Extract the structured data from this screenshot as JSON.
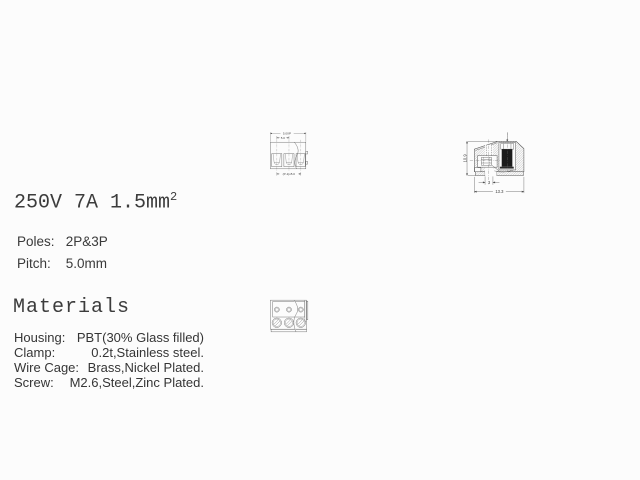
{
  "page": {
    "background": "#fcfcfc"
  },
  "colors": {
    "line": "#4a4a4a",
    "text": "#3a3a3a",
    "screw_fill": "#1c1c1c"
  },
  "specs": {
    "rating": "250V 7A 1.5mm",
    "rating_superscript": "2",
    "poles_label": "Poles:",
    "poles_value": "2P&3P",
    "pitch_label": "Pitch:",
    "pitch_value": "5.0mm"
  },
  "materials": {
    "title": "Materials",
    "rows": [
      {
        "label": "Housing:",
        "value": "PBT(30% Glass filled)"
      },
      {
        "label": "Clamp:",
        "value": "0.2t,Stainless steel."
      },
      {
        "label": "Wire Cage:",
        "value": "Brass,Nickel Plated."
      },
      {
        "label": "Screw:",
        "value": "M2.6,Steel,Zinc Plated."
      }
    ]
  },
  "front_view": {
    "dim_total_width": "5.0XP",
    "dim_pitch": "5.0",
    "dim_span": "(P-1)x5.0"
  },
  "side_view": {
    "dim_height": "10.9",
    "dim_foot": "3",
    "dim_depth": "13.3"
  }
}
